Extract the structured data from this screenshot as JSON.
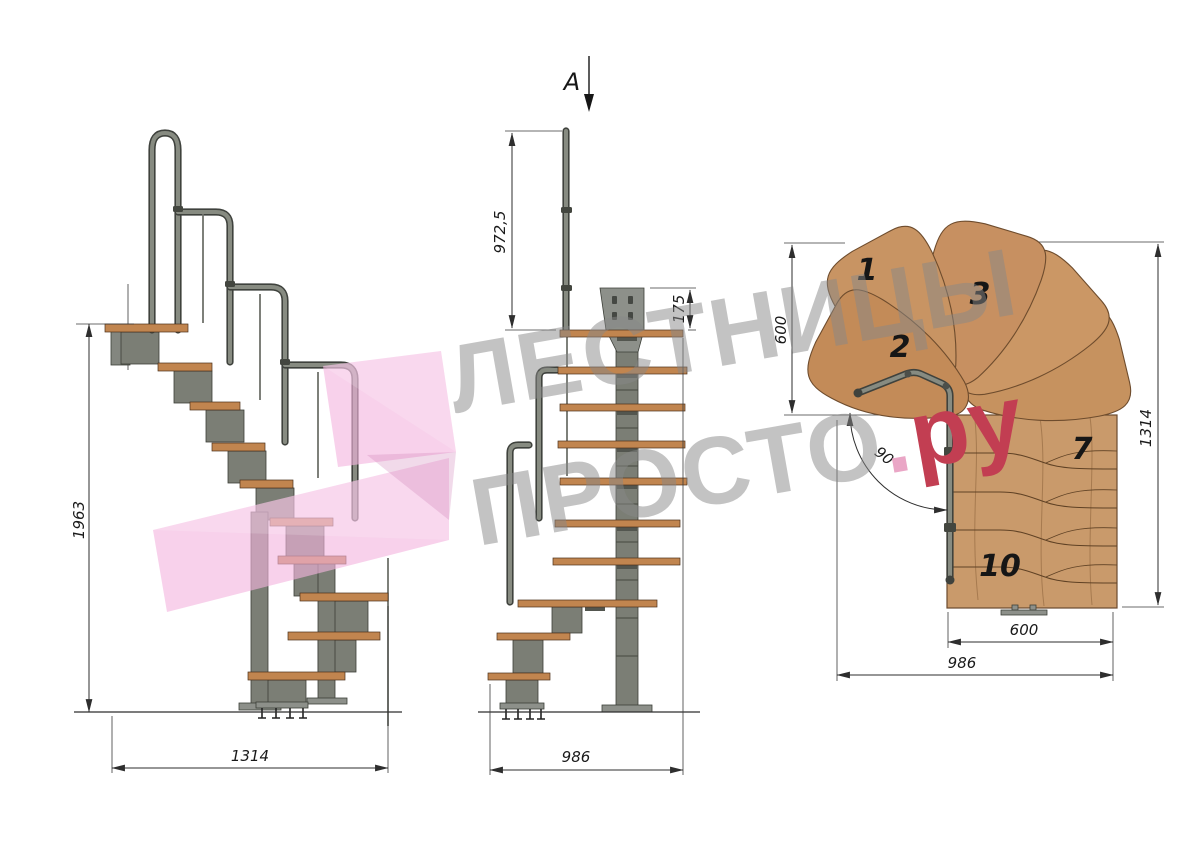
{
  "watermark": {
    "line1": "ЛЕСТНИЦЫ",
    "line2": "ПРОСТО",
    "dot": ".",
    "suffix": "ру"
  },
  "side_view": {
    "height_dim": "1963",
    "width_dim": "1314"
  },
  "front_view": {
    "section_mark": "A",
    "post_height_dim": "972,5",
    "plate_height_dim": "175",
    "width_dim": "986"
  },
  "plan_view": {
    "fan_depth_dim": "600",
    "total_length_dim": "1314",
    "turn_angle_dim": "90°",
    "flight_width_dim": "600",
    "overall_width_dim": "986",
    "steps": {
      "n1": "1",
      "n2": "2",
      "n3": "3",
      "n7": "7",
      "n10": "10"
    }
  },
  "colors": {
    "wood_side": "#c1854f",
    "wood_plan": "#c99a6b",
    "metal": "#7b7e75",
    "metal_dark": "#45483f",
    "dim_line": "#2e2e2e",
    "watermark_gray": "#878787",
    "watermark_red": "#c23e52",
    "watermark_dot": "#eaa6c6",
    "arrow_pink": "#f3b5de"
  }
}
